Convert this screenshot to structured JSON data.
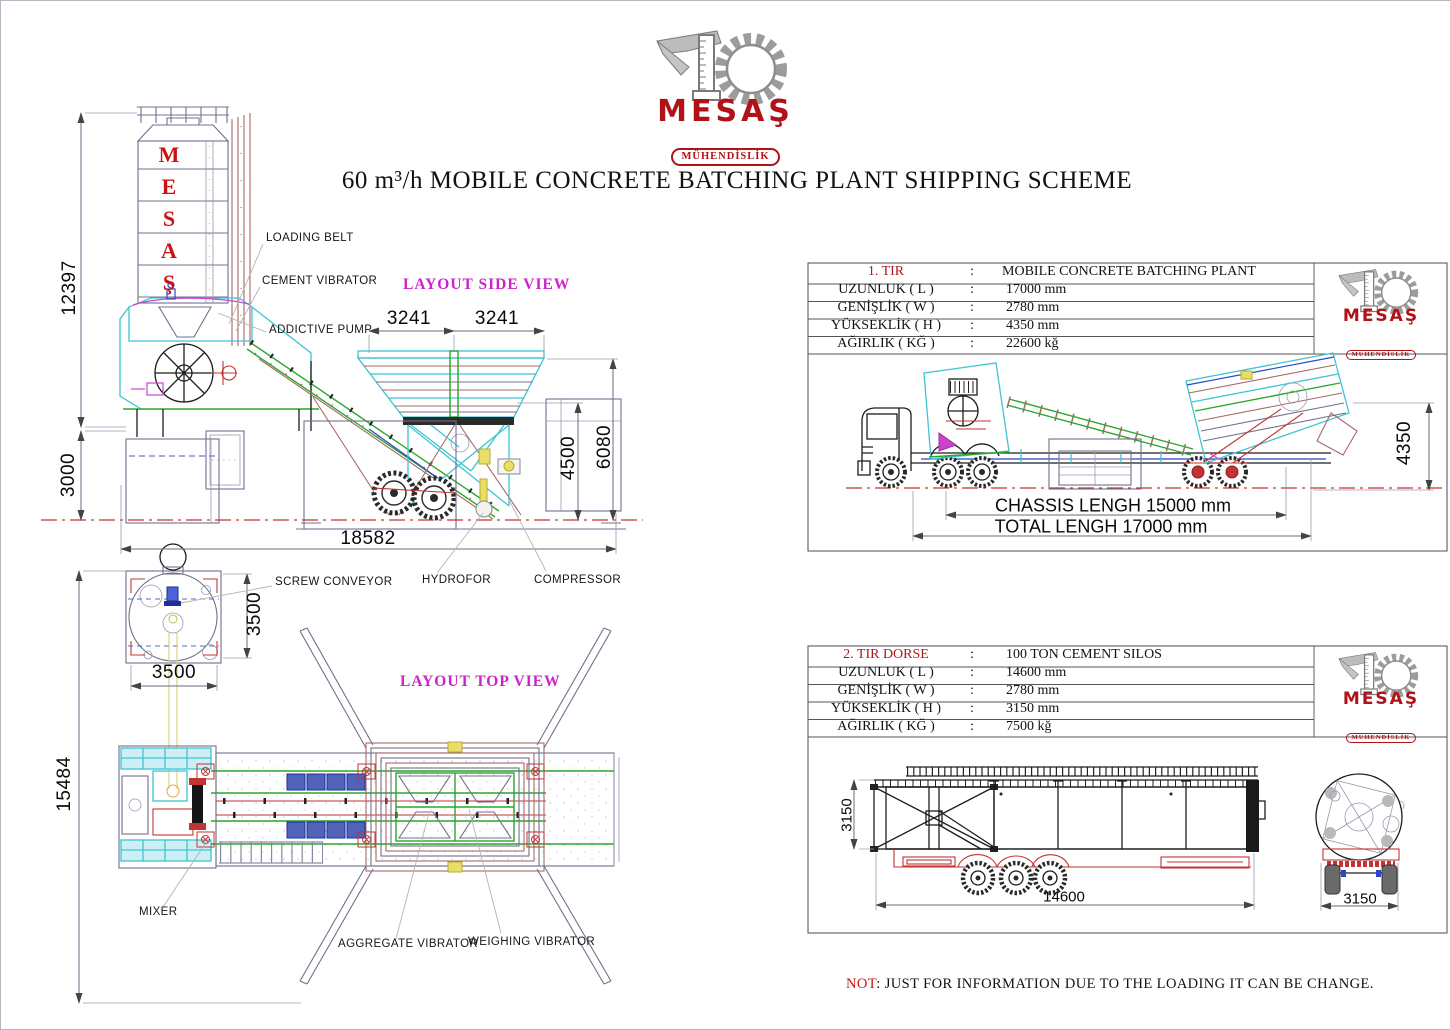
{
  "brand": {
    "name": "MESAŞ",
    "sub": "MÜHENDİSLİK"
  },
  "title": "60 m³/h MOBILE CONCRETE BATCHING PLANT SHIPPING SCHEME",
  "silo_letters": [
    "M",
    "E",
    "S",
    "A",
    "Ş"
  ],
  "side_view": {
    "title": "LAYOUT SIDE VIEW",
    "labels": {
      "loading_belt": "LOADING BELT",
      "cement_vibrator": "CEMENT VIBRATOR",
      "addictive_pump": "ADDICTIVE PUMP"
    },
    "dims": {
      "silo_height": "12397",
      "foundation_height": "3000",
      "total_length": "18582",
      "bin_left": "3241",
      "bin_right": "3241",
      "bin_height": "4500",
      "overall_height": "6080"
    }
  },
  "top_view": {
    "title": "LAYOUT TOP VIEW",
    "labels": {
      "screw_conveyor": "SCREW CONVEYOR",
      "hydrofor": "HYDROFOR",
      "compressor": "COMPRESSOR",
      "mixer": "MIXER",
      "aggregate_vibrator": "AGGREGATE VIBRATOR",
      "weighing_vibrator": "WEIGHING VIBRATOR"
    },
    "dims": {
      "plant_length": "15484",
      "silo_width": "3500",
      "silo_depth": "3500"
    }
  },
  "truck1": {
    "table": {
      "rows": [
        {
          "label": "1. TIR",
          "sep": ":",
          "value": "MOBILE CONCRETE BATCHING PLANT"
        },
        {
          "label": "UZUNLUK ( L )",
          "sep": ":",
          "value": "17000 mm"
        },
        {
          "label": "GENİŞLİK ( W )",
          "sep": ":",
          "value": "2780 mm"
        },
        {
          "label": "YÜKSEKLİK ( H )",
          "sep": ":",
          "value": "4350 mm"
        },
        {
          "label": "AĞIRLIK ( KĞ )",
          "sep": ":",
          "value": "22600 kğ"
        }
      ]
    },
    "dims": {
      "height": "4350",
      "chassis": "CHASSIS LENGH 15000 mm",
      "total": "TOTAL LENGH 17000 mm"
    }
  },
  "truck2": {
    "table": {
      "rows": [
        {
          "label": "2. TIR DORSE",
          "sep": ":",
          "value": "100 TON CEMENT SILOS"
        },
        {
          "label": "UZUNLUK ( L )",
          "sep": ":",
          "value": "14600 mm"
        },
        {
          "label": "GENİŞLİK ( W )",
          "sep": ":",
          "value": "2780 mm"
        },
        {
          "label": "YÜKSEKLİK ( H )",
          "sep": ":",
          "value": "3150 mm"
        },
        {
          "label": "AĞIRLIK ( KĞ )",
          "sep": ":",
          "value": "7500 kğ"
        }
      ]
    },
    "dims": {
      "height": "3150",
      "length": "14600",
      "rear_width": "3150"
    }
  },
  "note": {
    "prefix": "NOT",
    "text": ": JUST FOR INFORMATION DUE TO THE LOADING IT CAN BE CHANGE."
  },
  "colors": {
    "brand_red": "#b01217",
    "cad_cyan": "#3fc4d2",
    "cad_green": "#2ca62c",
    "cad_magenta": "#cc22cc",
    "cad_red": "#c23333"
  }
}
